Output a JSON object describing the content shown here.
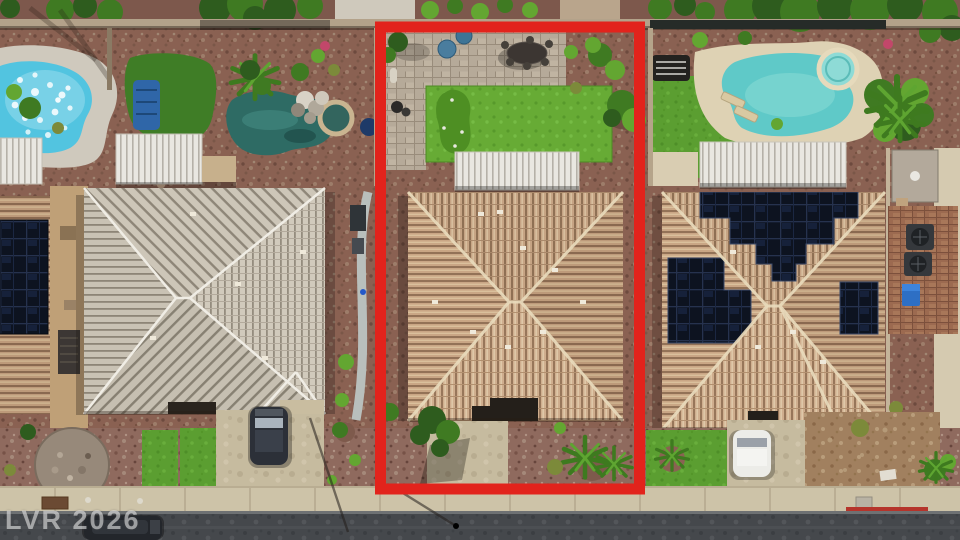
{
  "watermark": {
    "text": "LVR 2026"
  },
  "colors": {
    "outline_red": "#e2231c",
    "curb_red": "#b5342b",
    "watermark_gray": "#e0e0e0",
    "pool_cyan": "#52c4e0",
    "pool_teal": "#2e6b64",
    "pool_turquoise": "#5fc9c8",
    "lawn_green": "#5b9e31",
    "putting_green": "#4e8f23",
    "roof_tan": "#c6a484",
    "roof_gray": "#ccc5b7",
    "solar_navy": "#0d1320",
    "asphalt_gray": "#45484c",
    "sidewalk_tan": "#cdc3a8",
    "gravel_red": "#8a6152",
    "gravel_mauve": "#8f6a5e",
    "deck_cream": "#ded2b4"
  }
}
